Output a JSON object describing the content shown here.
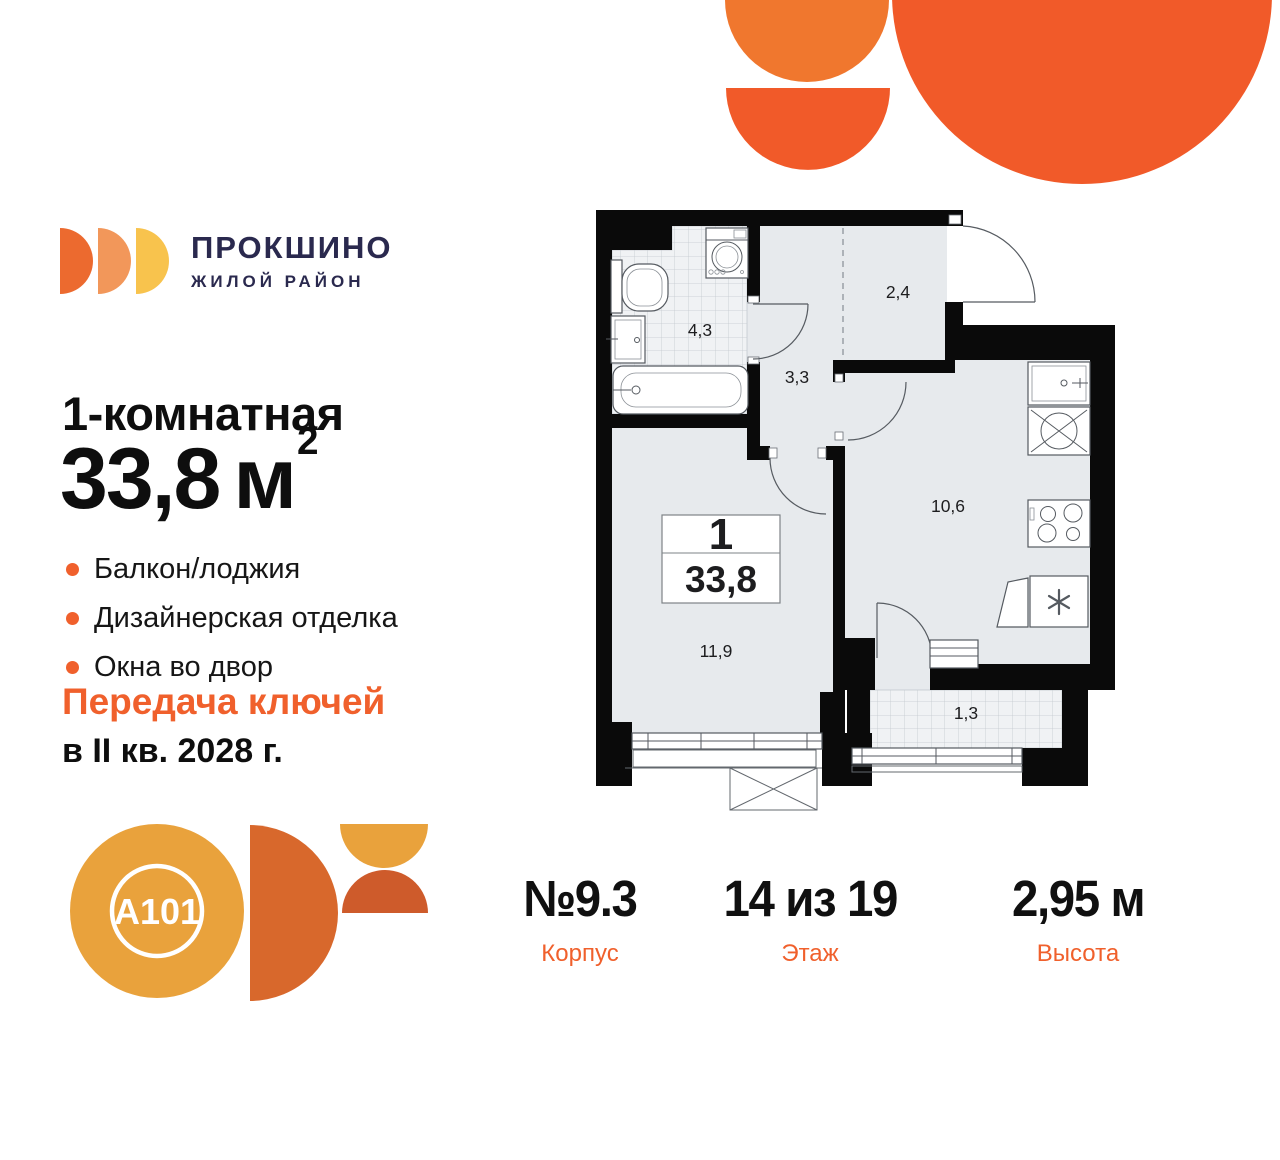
{
  "logo": {
    "title": "ПРОКШИНО",
    "subtitle": "ЖИЛОЙ РАЙОН"
  },
  "listing": {
    "type_title": "1-комнатная",
    "area": "33,8",
    "area_unit": "м",
    "area_sup": "2",
    "features": [
      "Балкон/лоджия",
      "Дизайнерская отделка",
      "Окна во двор"
    ],
    "keys_line1": "Передача ключей",
    "keys_line2": "в II кв. 2028 г."
  },
  "developer_logo": {
    "label": "A101"
  },
  "plan": {
    "unit_rooms": "1",
    "unit_area": "33,8",
    "labels": {
      "bathroom": "4,3",
      "hall": "3,3",
      "wardrobe": "2,4",
      "kitchen": "10,6",
      "living": "11,9",
      "balcony": "1,3"
    }
  },
  "stats": {
    "items": [
      {
        "value": "№9.3",
        "label": "Корпус"
      },
      {
        "value": "14 из 19",
        "label": "Этаж"
      },
      {
        "value": "2,95 м",
        "label": "Высота"
      }
    ]
  },
  "colors": {
    "accent_orange": "#F0602C",
    "deco_orange": "#F15A29",
    "deco_orange_light": "#F0772E",
    "brand_navy": "#2A294E",
    "logo_mark_colors": [
      "#EC6A2F",
      "#F2975A",
      "#F8C34D"
    ],
    "a101_gold": "#E9A23C",
    "a101_half_circle": "#D8682C",
    "a101_small_dome": "#CE5B2B",
    "plan_wall": "#0a0a0a",
    "plan_floor": "#e7eaed"
  }
}
